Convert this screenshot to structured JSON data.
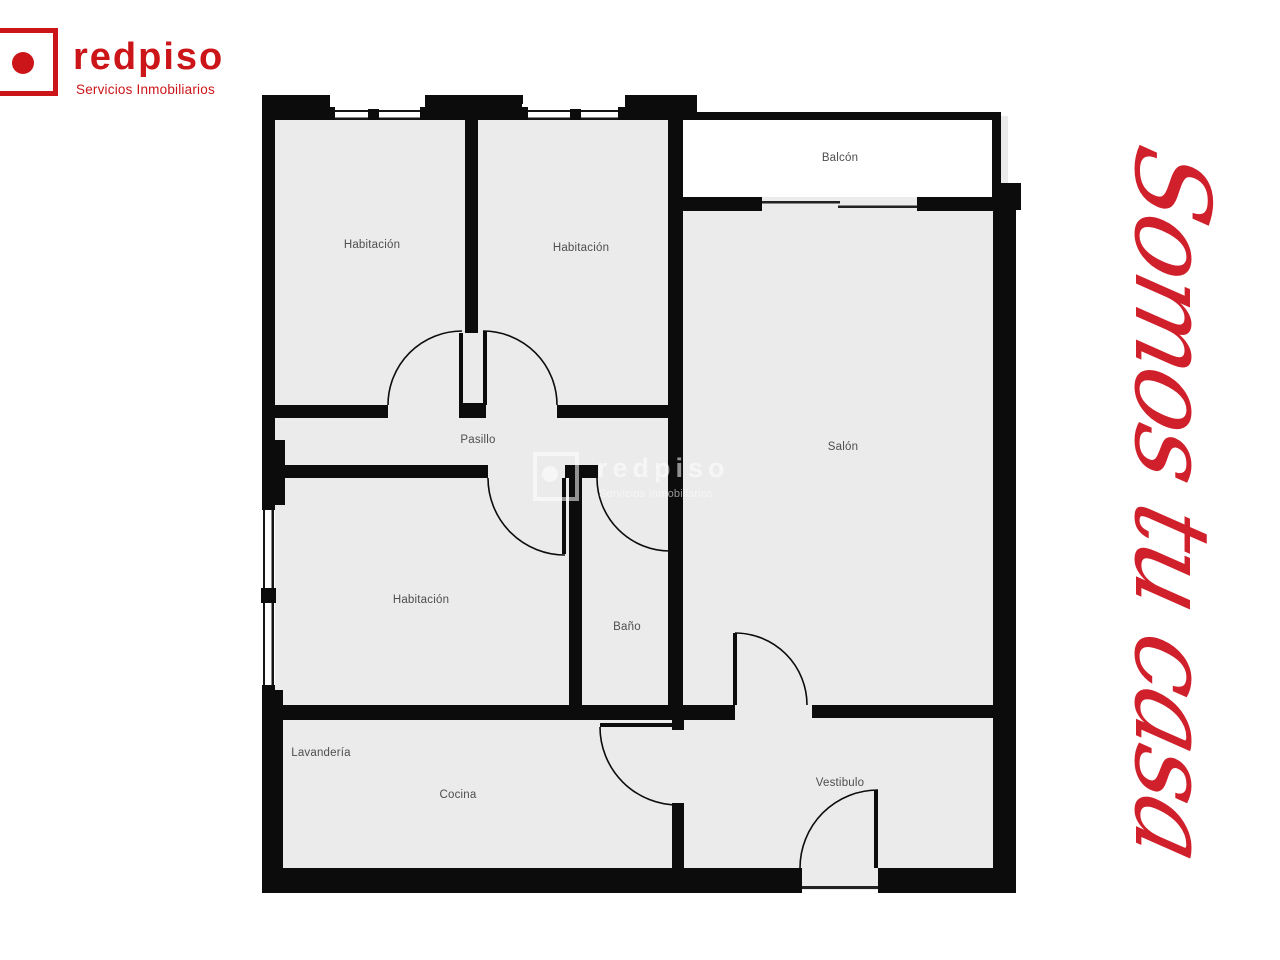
{
  "brand": {
    "wordmark": "redpiso",
    "tagline": "Servicios Inmobiliarios",
    "red": "#cb1519"
  },
  "slogan": {
    "text": "Somos tu casa",
    "color": "#d0202b"
  },
  "watermark": {
    "wordmark": "redpiso",
    "tagline": "Servicios Inmobiliarios"
  },
  "floorplan": {
    "wall_color": "#0c0c0c",
    "floor_color": "#ebebeb",
    "label_color": "#4e4e4e",
    "rooms": [
      {
        "id": "habitacion-1",
        "label": "Habitación",
        "x": 372,
        "y": 245
      },
      {
        "id": "habitacion-2",
        "label": "Habitación",
        "x": 581,
        "y": 248
      },
      {
        "id": "balcon",
        "label": "Balcón",
        "x": 840,
        "y": 158
      },
      {
        "id": "salon",
        "label": "Salón",
        "x": 843,
        "y": 447
      },
      {
        "id": "pasillo",
        "label": "Pasillo",
        "x": 478,
        "y": 440
      },
      {
        "id": "habitacion-3",
        "label": "Habitación",
        "x": 421,
        "y": 600
      },
      {
        "id": "bano",
        "label": "Baño",
        "x": 627,
        "y": 627
      },
      {
        "id": "lavanderia",
        "label": "Lavandería",
        "x": 321,
        "y": 753
      },
      {
        "id": "cocina",
        "label": "Cocina",
        "x": 458,
        "y": 795
      },
      {
        "id": "vestibulo",
        "label": "Vestibulo",
        "x": 840,
        "y": 783
      }
    ]
  }
}
